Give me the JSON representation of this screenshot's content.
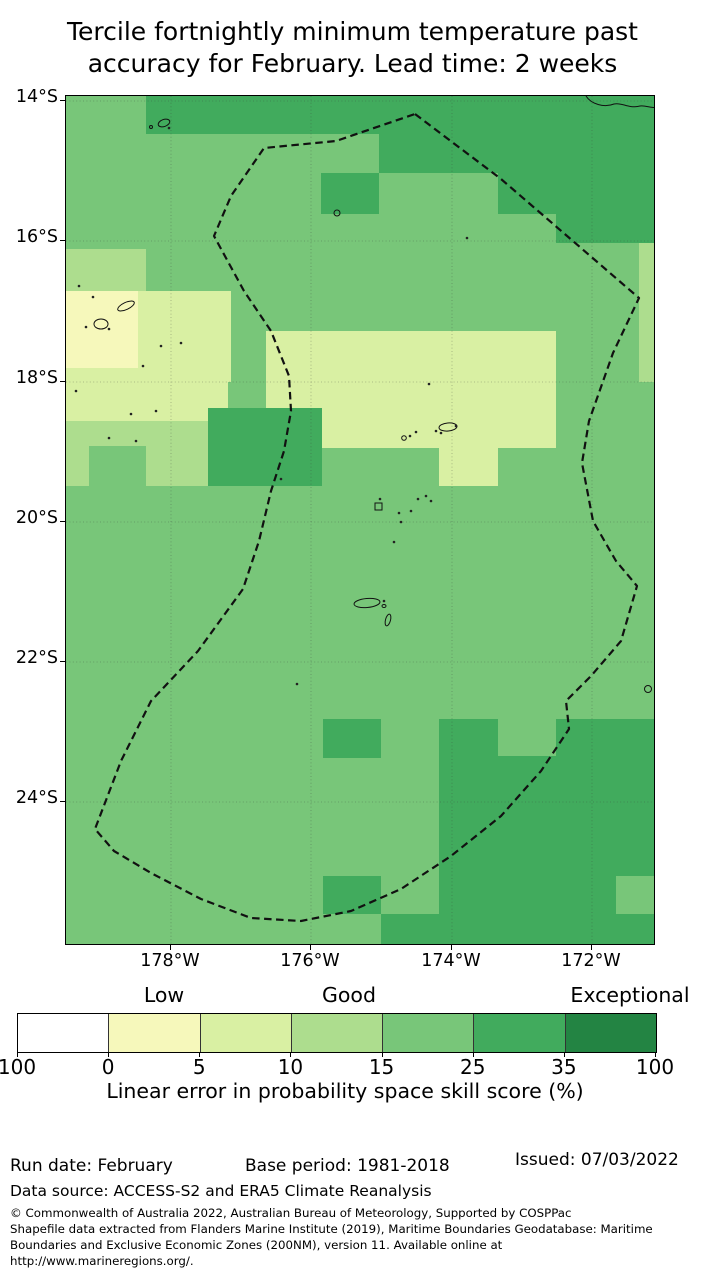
{
  "title": {
    "line1": "Tercile fortnightly minimum temperature past",
    "line2": "accuracy for February. Lead time: 2 weeks"
  },
  "map": {
    "lat_labels": [
      {
        "label": "14°S",
        "y": 100
      },
      {
        "label": "16°S",
        "y": 240
      },
      {
        "label": "18°S",
        "y": 381
      },
      {
        "label": "20°S",
        "y": 521
      },
      {
        "label": "22°S",
        "y": 661
      },
      {
        "label": "24°S",
        "y": 801
      }
    ],
    "lon_labels": [
      {
        "label": "178°W",
        "x": 170
      },
      {
        "label": "176°W",
        "x": 310
      },
      {
        "label": "174°W",
        "x": 451
      },
      {
        "label": "172°W",
        "x": 591
      }
    ]
  },
  "chart_data": {
    "type": "choropleth-map",
    "value_label": "Linear error in probability space skill score (%)",
    "scale_thresholds": [
      -100,
      0,
      5,
      10,
      15,
      25,
      35,
      100
    ],
    "scale_categories": [
      {
        "label": "Low",
        "x": 164
      },
      {
        "label": "Good",
        "x": 349
      },
      {
        "label": "Exceptional",
        "x": 630
      }
    ],
    "colors": {
      "g1": "#78c679",
      "g2": "#41ab5d",
      "l1": "#addd8e",
      "l2": "#d9f0a3",
      "l3": "#f6f8bb"
    },
    "base_color": "g1",
    "cells": [
      {
        "x": 80,
        "y": 0,
        "w": 510,
        "h": 38,
        "c": "g2"
      },
      {
        "x": 313,
        "y": 38,
        "w": 177,
        "h": 39,
        "c": "g2"
      },
      {
        "x": 432,
        "y": 77,
        "w": 58,
        "h": 41,
        "c": "g2"
      },
      {
        "x": 490,
        "y": 38,
        "w": 100,
        "h": 109,
        "c": "g2"
      },
      {
        "x": 255,
        "y": 77,
        "w": 58,
        "h": 41,
        "c": "g2"
      },
      {
        "x": 573,
        "y": 147,
        "w": 17,
        "h": 139,
        "c": "l1"
      },
      {
        "x": 0,
        "y": 153,
        "w": 80,
        "h": 42,
        "c": "l1"
      },
      {
        "x": 0,
        "y": 195,
        "w": 72,
        "h": 77,
        "c": "l3"
      },
      {
        "x": 72,
        "y": 195,
        "w": 93,
        "h": 91,
        "c": "l2"
      },
      {
        "x": 0,
        "y": 272,
        "w": 162,
        "h": 53,
        "c": "l2"
      },
      {
        "x": 0,
        "y": 325,
        "w": 165,
        "h": 65,
        "c": "l1"
      },
      {
        "x": 23,
        "y": 350,
        "w": 57,
        "h": 40,
        "c": "g1"
      },
      {
        "x": 200,
        "y": 235,
        "w": 290,
        "h": 117,
        "c": "l2"
      },
      {
        "x": 373,
        "y": 352,
        "w": 59,
        "h": 38,
        "c": "l2"
      },
      {
        "x": 142,
        "y": 312,
        "w": 114,
        "h": 78,
        "c": "g2"
      },
      {
        "x": 257,
        "y": 623,
        "w": 58,
        "h": 39,
        "c": "g2"
      },
      {
        "x": 373,
        "y": 623,
        "w": 59,
        "h": 37,
        "c": "g2"
      },
      {
        "x": 490,
        "y": 623,
        "w": 100,
        "h": 84,
        "c": "g2"
      },
      {
        "x": 373,
        "y": 660,
        "w": 117,
        "h": 47,
        "c": "g2"
      },
      {
        "x": 373,
        "y": 707,
        "w": 217,
        "h": 111,
        "c": "g2"
      },
      {
        "x": 550,
        "y": 780,
        "w": 40,
        "h": 38,
        "c": "g1"
      },
      {
        "x": 315,
        "y": 818,
        "w": 275,
        "h": 32,
        "c": "g2"
      },
      {
        "x": 257,
        "y": 780,
        "w": 58,
        "h": 38,
        "c": "g2"
      }
    ],
    "gridlines": {
      "lats": [
        5,
        145,
        286,
        426,
        566,
        706
      ],
      "lons": [
        105,
        245,
        386,
        526
      ]
    },
    "eez_boundary": [
      [
        349,
        18
      ],
      [
        435,
        83
      ],
      [
        573,
        202
      ],
      [
        547,
        257
      ],
      [
        523,
        325
      ],
      [
        516,
        367
      ],
      [
        527,
        425
      ],
      [
        550,
        465
      ],
      [
        571,
        490
      ],
      [
        555,
        545
      ],
      [
        525,
        580
      ],
      [
        500,
        605
      ],
      [
        503,
        633
      ],
      [
        475,
        675
      ],
      [
        435,
        720
      ],
      [
        385,
        760
      ],
      [
        335,
        793
      ],
      [
        285,
        815
      ],
      [
        235,
        825
      ],
      [
        185,
        822
      ],
      [
        135,
        803
      ],
      [
        85,
        777
      ],
      [
        48,
        755
      ],
      [
        29,
        733
      ],
      [
        55,
        665
      ],
      [
        85,
        605
      ],
      [
        132,
        555
      ],
      [
        177,
        493
      ],
      [
        193,
        445
      ],
      [
        205,
        395
      ],
      [
        218,
        355
      ],
      [
        225,
        315
      ],
      [
        223,
        280
      ],
      [
        205,
        235
      ],
      [
        178,
        195
      ],
      [
        148,
        140
      ],
      [
        165,
        100
      ],
      [
        198,
        52
      ],
      [
        270,
        45
      ]
    ],
    "islands": {
      "dots": [
        [
          13,
          190
        ],
        [
          27,
          201
        ],
        [
          20,
          231
        ],
        [
          43,
          233
        ],
        [
          10,
          295
        ],
        [
          43,
          342
        ],
        [
          65,
          318
        ],
        [
          95,
          250
        ],
        [
          115,
          247
        ],
        [
          77,
          270
        ],
        [
          90,
          315
        ],
        [
          70,
          345
        ],
        [
          215,
          383
        ],
        [
          231,
          588
        ],
        [
          401,
          142
        ],
        [
          363,
          288
        ],
        [
          345,
          415
        ],
        [
          333,
          417
        ],
        [
          335,
          426
        ],
        [
          328,
          446
        ],
        [
          352,
          403
        ],
        [
          360,
          400
        ],
        [
          365,
          405
        ],
        [
          314,
          403
        ],
        [
          350,
          336
        ],
        [
          344,
          340
        ],
        [
          370,
          335
        ],
        [
          375,
          337
        ],
        [
          390,
          330
        ],
        [
          318,
          505
        ],
        [
          103,
          32
        ]
      ],
      "rings": [
        [
          271,
          117,
          3
        ],
        [
          338,
          342,
          2.3
        ],
        [
          582,
          593,
          3.5
        ],
        [
          85,
          31,
          1.5
        ]
      ],
      "ellipses": [
        [
          35,
          228,
          7,
          5,
          0
        ],
        [
          60,
          210,
          9,
          3.5,
          -25
        ],
        [
          98,
          27,
          6,
          3.5,
          -20
        ],
        [
          382,
          331,
          9,
          4,
          -5
        ],
        [
          301,
          507,
          13,
          4.5,
          -5
        ],
        [
          322,
          524,
          2.5,
          6,
          15
        ],
        [
          318,
          510,
          2,
          1.5,
          0
        ]
      ],
      "rects": [
        [
          309,
          407,
          7,
          7
        ]
      ],
      "coast_paths": [
        "M520,0 C525,8 538,12 548,8 C556,6 562,13 574,10 C580,9 586,13 590,11"
      ]
    }
  },
  "legend": {
    "categories": [
      {
        "label": "Low",
        "x": 164
      },
      {
        "label": "Good",
        "x": 349
      },
      {
        "label": "Exceptional",
        "x": 630
      }
    ],
    "colors": [
      "#ffffff",
      "#f6f8bb",
      "#d9f0a3",
      "#addd8e",
      "#78c679",
      "#41ab5d",
      "#238443"
    ],
    "ticks": [
      "100",
      "0",
      "5",
      "10",
      "15",
      "25",
      "35",
      "100"
    ],
    "axis_label": "Linear error in probability space skill score (%)"
  },
  "footer": {
    "run_date": "Run date: February",
    "base_period": "Base period: 1981-2018",
    "issued": "Issued: 07/03/2022",
    "data_source": "Data source: ACCESS-S2 and ERA5 Climate Reanalysis",
    "copyright": [
      "© Commonwealth of Australia 2022, Australian Bureau of Meteorology, Supported by COSPPac",
      "Shapefile data extracted from Flanders Marine Institute (2019), Maritime Boundaries Geodatabase: Maritime",
      "Boundaries and Exclusive Economic Zones (200NM), version 11. Available online at",
      "http://www.marineregions.org/."
    ]
  }
}
